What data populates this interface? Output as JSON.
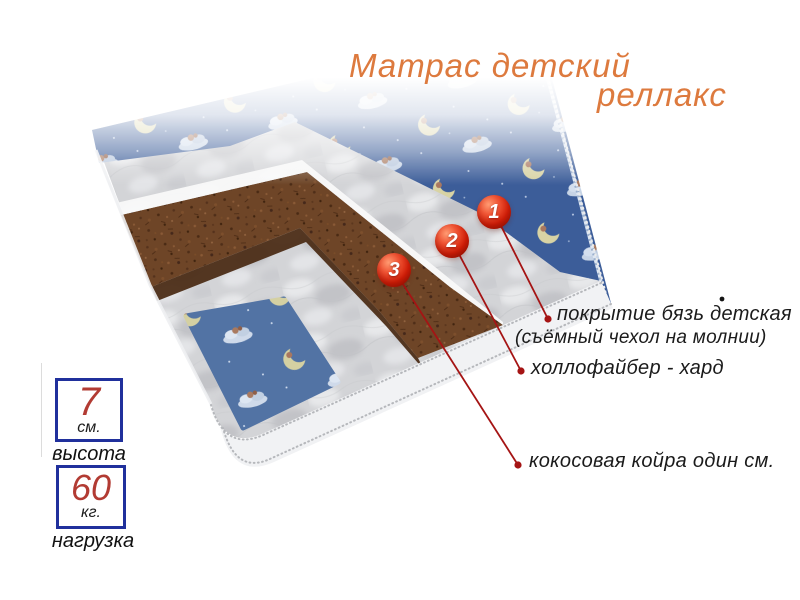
{
  "title": {
    "line1": "Матрас детский",
    "line2": "реллакс"
  },
  "callouts": [
    {
      "num": "1",
      "label": "покрытие  бязь детская",
      "sublabel": "(съёмный чехол на молнии)"
    },
    {
      "num": "2",
      "label": "холлофайбер - хард"
    },
    {
      "num": "3",
      "label": "кокосовая койра один см."
    }
  ],
  "specs": [
    {
      "value": "7",
      "unit": "см.",
      "caption": "высота"
    },
    {
      "value": "60",
      "unit": "кг.",
      "caption": "нагрузка"
    }
  ],
  "colors": {
    "title_orange": "#dd7a3e",
    "badge_red": "#d21e07",
    "callout_line_red": "#a51414",
    "label_text": "#1b1b1b",
    "spec_border_navy": "#20309c",
    "spec_value_red": "#b23b33",
    "fabric_blue_dark": "#3c5d99",
    "fabric_blue_light": "#5273a4",
    "quilt_grey": "#d3d4d7",
    "coir_brown": "#6e4527"
  }
}
